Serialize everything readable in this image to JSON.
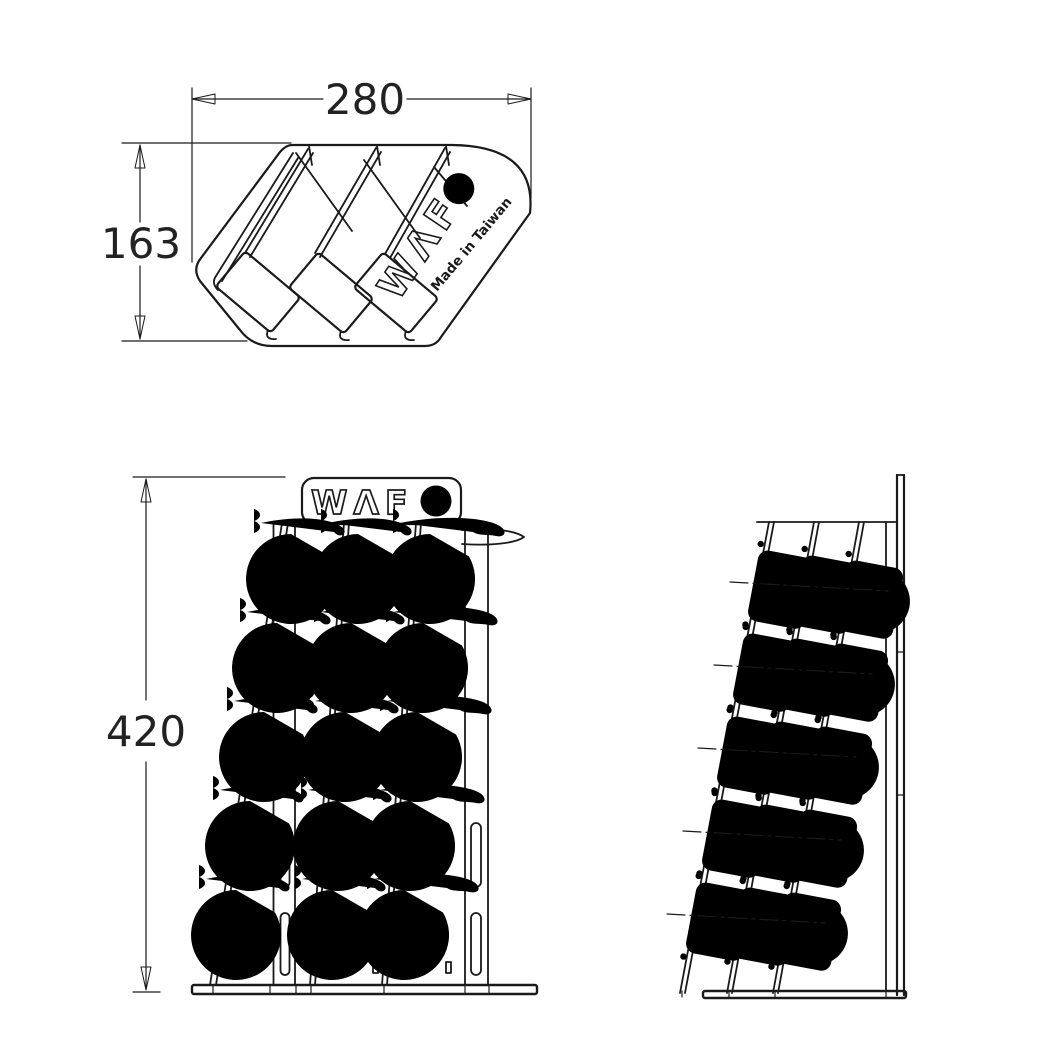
{
  "colors": {
    "background": "#ffffff",
    "line": "#1a1a1a",
    "dim_text": "#222222"
  },
  "views": {
    "top": {
      "dim_width_label": "280",
      "dim_depth_label": "163",
      "logo_text": "WAFO",
      "logo_letters": "WΛF",
      "made_in_label": "Made in Taiwan",
      "pocket_count": 3
    },
    "front": {
      "dim_height_label": "420",
      "logo_text": "WAFO",
      "logo_letters": "WΛF",
      "hook_rows": 5,
      "hook_columns": 3
    },
    "side": {
      "hook_rows": 5,
      "hook_columns": 3
    }
  }
}
